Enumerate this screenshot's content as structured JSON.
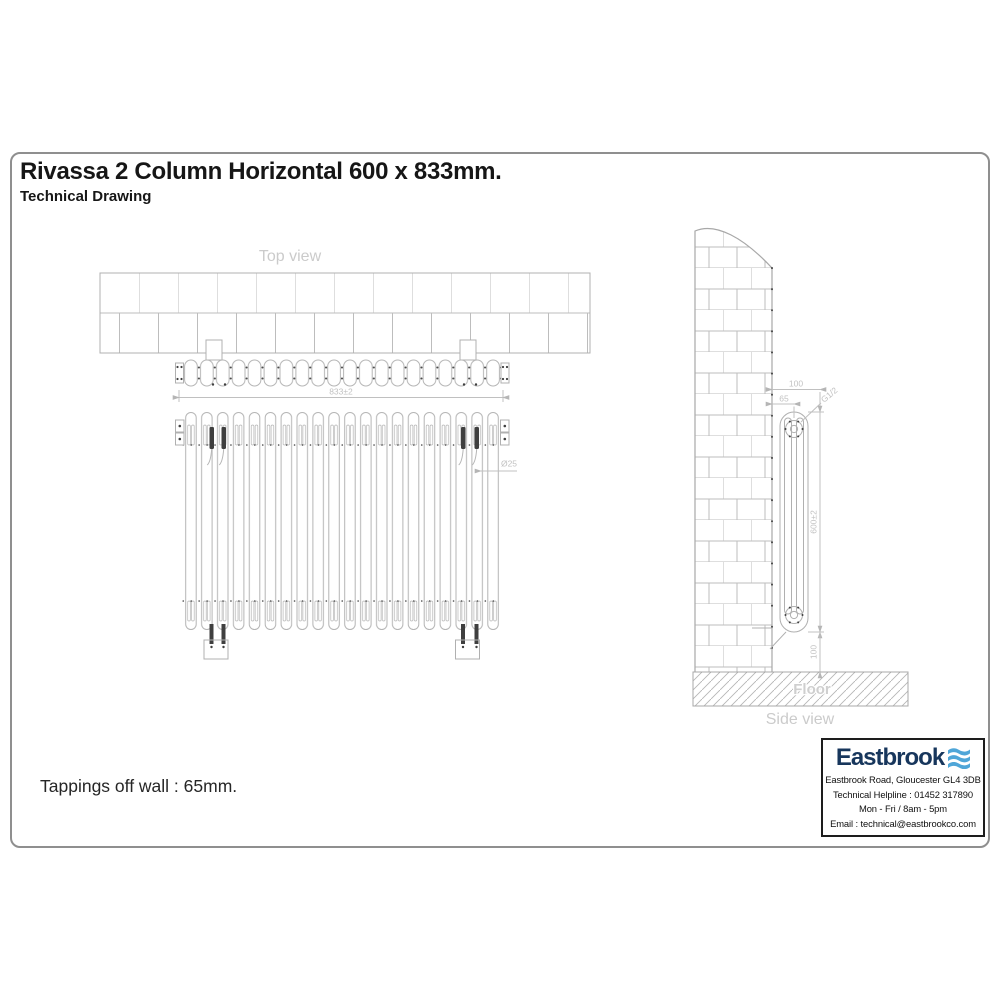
{
  "header": {
    "title": "Rivassa 2 Column Horizontal 600 x 833mm.",
    "subtitle": "Technical Drawing"
  },
  "views": {
    "top": {
      "label": "Top view",
      "width_dim": "833±2",
      "sections": 20
    },
    "front": {
      "tube_dim": "Ø25"
    },
    "side": {
      "label": "Side view",
      "floor_label": "Floor",
      "wall_to_front_dim": "100",
      "wall_to_tapping_dim": "65",
      "tapping_thread": "G1/2",
      "height_dim": "600±2",
      "floor_clearance_dim": "100"
    }
  },
  "note": "Tappings off wall : 65mm.",
  "vendor": {
    "name": "Eastbrook",
    "logo_icon": "three-wave-bars",
    "address": "Eastbrook Road, Gloucester GL4 3DB",
    "helpline": "Technical Helpline : 01452 317890",
    "hours": "Mon - Fri / 8am - 5pm",
    "email": "Email : technical@eastbrookco.com",
    "brand_navy": "#17365c",
    "brand_blue": "#4fa6d8"
  },
  "colors": {
    "line": "#b5b5b5",
    "dim_text": "#c2c2c2",
    "accent_dark": "#3f3f3f"
  }
}
